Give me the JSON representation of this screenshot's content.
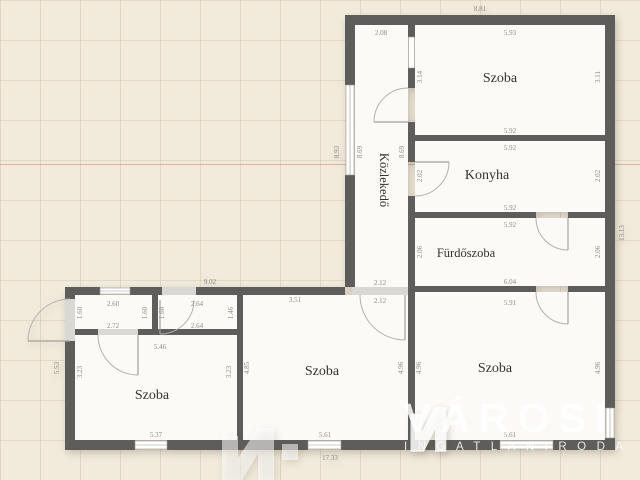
{
  "watermark": {
    "brand": "VÁROSI",
    "subtitle": "INGATLANIRODA"
  },
  "overall_dims": {
    "top": "8.81",
    "bottom": "17.33",
    "right": "13.13",
    "left_wing_top": "9.02",
    "left_wing_left": "5.53",
    "corridor_outer_left": "8.93"
  },
  "rooms": {
    "korridor": {
      "label": "Közlekedő",
      "dims": {
        "top": "2.08",
        "inner_left": "8.69",
        "inner_right": "8.69",
        "bottom_inner": "2.12",
        "bottom_outer": "2.12"
      }
    },
    "szoba_ne": {
      "label": "Szoba",
      "dims": {
        "top": "5.93",
        "left": "3.14",
        "right": "3.11",
        "bottom": "5.92"
      }
    },
    "konyha": {
      "label": "Konyha",
      "dims": {
        "top": "5.92",
        "left": "2.02",
        "right": "2.02",
        "bottom": "5.92"
      }
    },
    "furdoszoba": {
      "label": "Fürdőszoba",
      "dims": {
        "top": "5.92",
        "left": "2.06",
        "right": "2.06",
        "bottom": "6.04"
      }
    },
    "szoba_se": {
      "label": "Szoba",
      "dims": {
        "top": "5.91",
        "left": "4.96",
        "right": "4.96",
        "bottom": "5.61"
      }
    },
    "szoba_mid": {
      "label": "Szoba",
      "dims": {
        "top": "3.51",
        "left": "4.85",
        "right": "4.96",
        "bottom": "5.61"
      }
    },
    "szoba_sw": {
      "label": "Szoba",
      "dims": {
        "top": "5.46",
        "left": "3.23",
        "right": "3.23",
        "bottom": "5.37"
      }
    },
    "kamra_left": {
      "dims": {
        "top": "2.60",
        "left": "1.60",
        "right": "1.60",
        "bottom": "2.72"
      }
    },
    "kamra_right": {
      "dims": {
        "top": "2.64",
        "left": "1.60",
        "right": "1.46",
        "bottom": "2.64"
      }
    }
  },
  "colors": {
    "wall": "#5e5d5b",
    "room": "#fbfaf7",
    "background": "#f2ebdc",
    "dim_text": "#8d8b87",
    "accent_line": "#c8786a"
  }
}
